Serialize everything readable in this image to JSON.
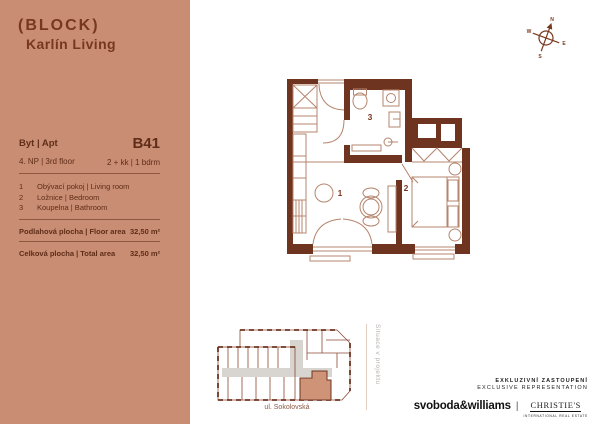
{
  "brand": {
    "logo_line1": "(BLOCK)",
    "logo_line2": "Karlín Living"
  },
  "panel": {
    "apt_label": "Byt | Apt",
    "apt_code": "B41",
    "floor": "4. NP | 3rd floor",
    "layout": "2 + kk | 1 bdrm",
    "rooms": [
      {
        "num": "1",
        "name": "Obývací pokoj | Living room"
      },
      {
        "num": "2",
        "name": "Ložnice | Bedroom"
      },
      {
        "num": "3",
        "name": "Koupelna | Bathroom"
      }
    ],
    "areas": [
      {
        "label": "Podlahová plocha | Floor area",
        "value": "32,50 m²"
      },
      {
        "label": "Celková plocha | Total area",
        "value": "32,50 m²"
      }
    ]
  },
  "plan": {
    "room_labels": [
      "1",
      "2",
      "3"
    ]
  },
  "compass": {
    "n": "N",
    "e": "E",
    "s": "S",
    "w": "W"
  },
  "siteplan": {
    "street": "ul. Sokolovská",
    "caption": "Situace v projektu"
  },
  "footer": {
    "line1": "EXKLUZIVNÍ ZASTOUPENÍ",
    "line2": "EXCLUSIVE REPRESENTATION",
    "brand1": "svoboda&williams",
    "separator": "|",
    "brand2": "CHRISTIE'S",
    "brand2_sub": "INTERNATIONAL REAL ESTATE"
  },
  "colors": {
    "panel_bg": "#c98d73",
    "panel_text": "#5f2d18",
    "wall": "#6e3420",
    "plan_line": "#b5846c",
    "highlight_unit": "#cf9378",
    "corridor": "#d8d4d0"
  }
}
